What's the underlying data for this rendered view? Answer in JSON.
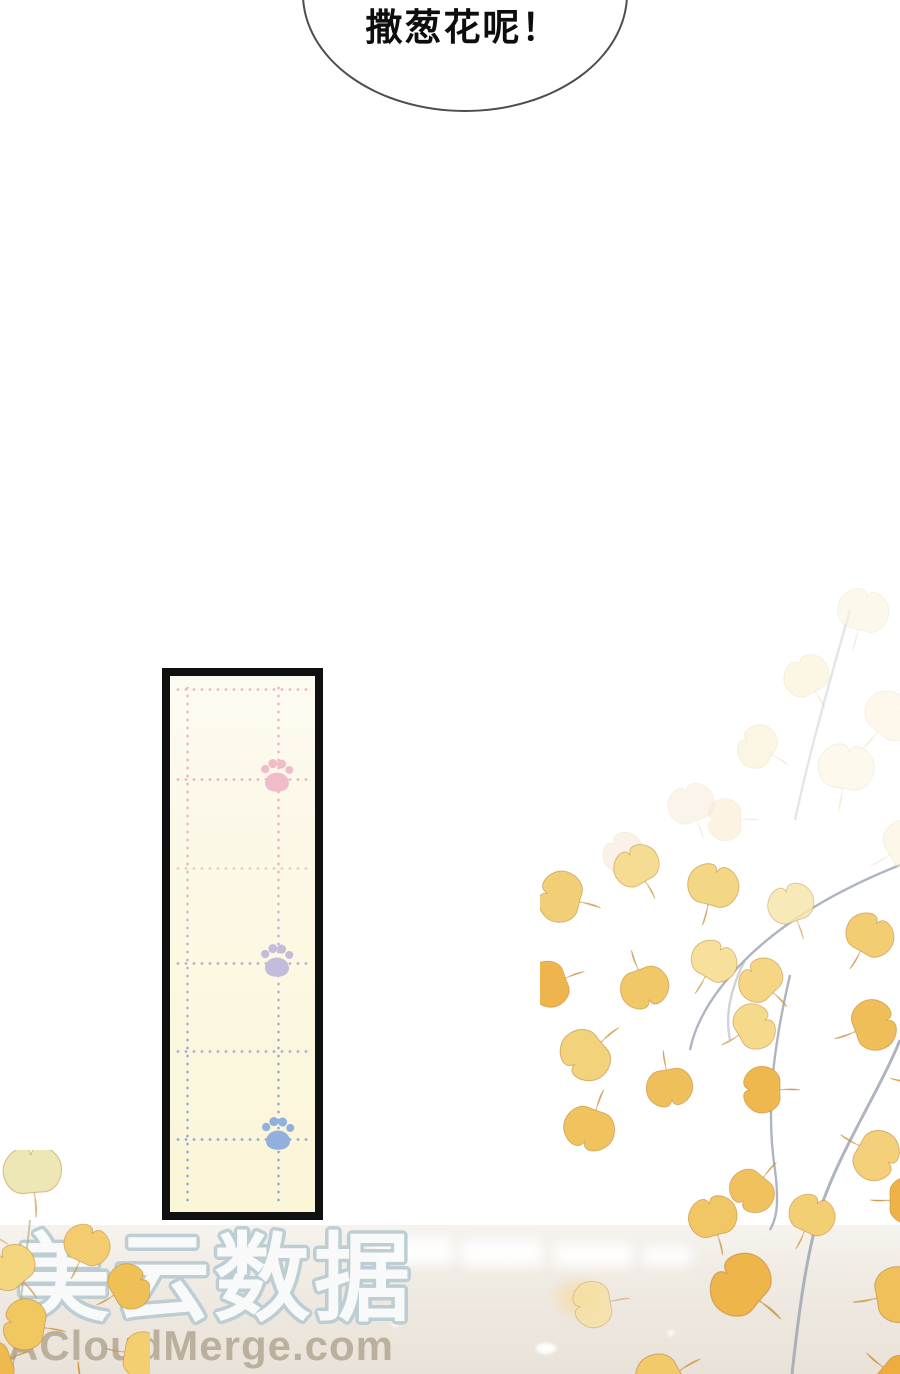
{
  "comic_page": {
    "speech_bubble": {
      "text": "撒葱花呢！"
    },
    "panel": {
      "kind": "paw-print-note-panel",
      "background_color": "#fcf8e4",
      "border_color": "#101010",
      "grid_dot_colors": {
        "pink": "#edb7c4",
        "purple": "#b6b0cc",
        "blue": "#92aed9"
      },
      "paws": [
        {
          "name": "pink-paw",
          "color": "#f0bcca"
        },
        {
          "name": "lavender-paw",
          "color": "#c3bcda"
        },
        {
          "name": "blue-paw",
          "color": "#92b0de"
        }
      ]
    },
    "watermark": {
      "site_name_cn": "美云数据",
      "site_url": "ACloudMerge.com",
      "cn_outline_color": "#b7cbd2",
      "url_color": "#b5a896"
    },
    "illustration": {
      "name": "ginkgo-branches",
      "palette": [
        "#f7e6ad",
        "#f2cc6e",
        "#eeb54b",
        "#e8a028",
        "#9aa3b2"
      ]
    }
  }
}
